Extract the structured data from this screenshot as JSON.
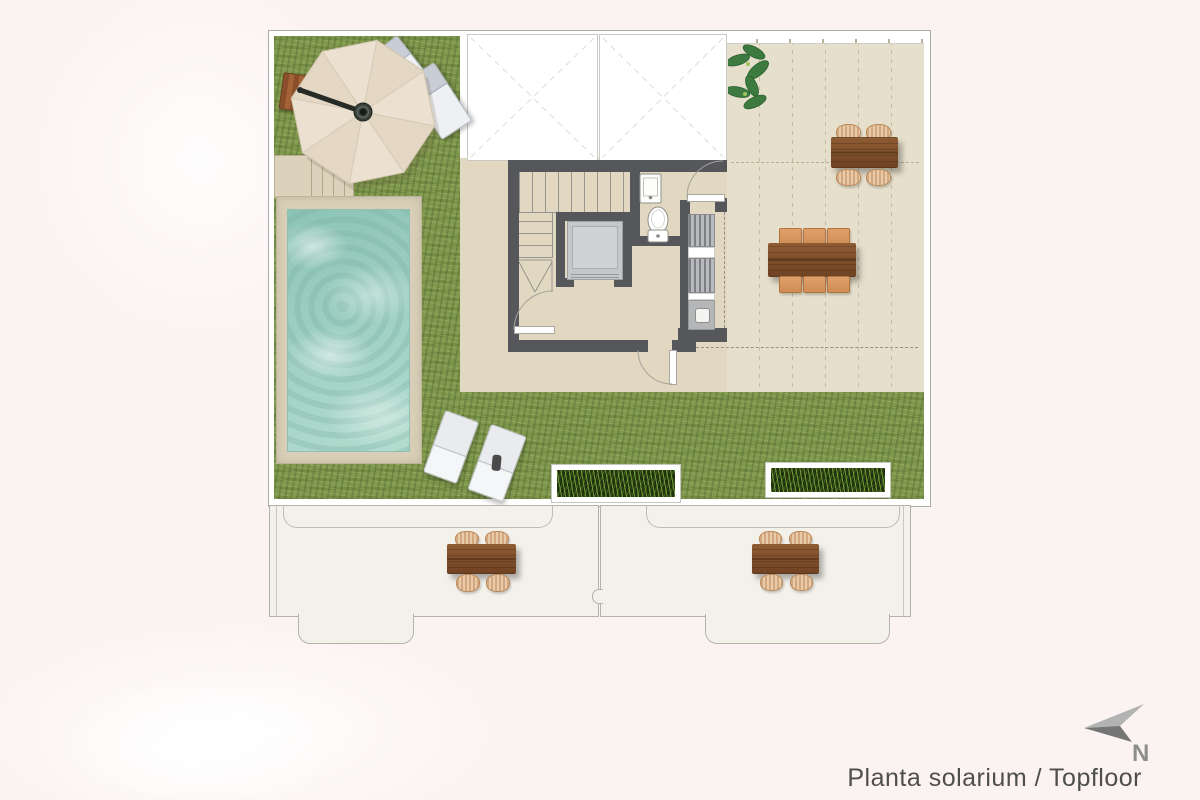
{
  "caption": {
    "text": "Planta solarium / Topfloor"
  },
  "compass": {
    "label": "N",
    "icon": "north-arrow-icon",
    "direction": "upper-left"
  },
  "plan": {
    "type": "architectural-floor-plan",
    "floor": "solarium / top floor",
    "areas": [
      {
        "id": "grass-left",
        "kind": "artificial-grass"
      },
      {
        "id": "grass-bottom-strip",
        "kind": "artificial-grass"
      },
      {
        "id": "pool",
        "kind": "swimming-pool"
      },
      {
        "id": "pool-deck",
        "kind": "deck"
      },
      {
        "id": "pool-steps",
        "kind": "steps"
      },
      {
        "id": "central-deck",
        "kind": "tiled-deck"
      },
      {
        "id": "roof-terrace",
        "kind": "tiled-terrace"
      },
      {
        "id": "skylight-void-1",
        "kind": "roof-void"
      },
      {
        "id": "skylight-void-2",
        "kind": "roof-void"
      },
      {
        "id": "stairwell",
        "kind": "staircase-core"
      },
      {
        "id": "elevator",
        "kind": "lift"
      },
      {
        "id": "toilet-room",
        "kind": "wc"
      },
      {
        "id": "utility-room",
        "kind": "ac-units-and-sink"
      },
      {
        "id": "balcony-left",
        "kind": "lower-floor-terrace"
      },
      {
        "id": "balcony-right",
        "kind": "lower-floor-terrace"
      }
    ],
    "furniture": [
      {
        "id": "cantilever-umbrella",
        "location": "grass-left"
      },
      {
        "id": "side-table-wood",
        "location": "grass-left"
      },
      {
        "id": "sun-lounger-1",
        "location": "grass-left"
      },
      {
        "id": "sun-lounger-2",
        "location": "grass-left"
      },
      {
        "id": "sun-lounger-3",
        "location": "grass-bottom-strip"
      },
      {
        "id": "sun-lounger-4",
        "location": "grass-bottom-strip"
      },
      {
        "id": "dining-set-4-seats",
        "location": "roof-terrace"
      },
      {
        "id": "dining-set-6-seats",
        "location": "roof-terrace"
      },
      {
        "id": "dining-set-4-seats",
        "location": "balcony-left"
      },
      {
        "id": "dining-set-4-seats",
        "location": "balcony-right"
      },
      {
        "id": "planter-1",
        "location": "grass-bottom-strip"
      },
      {
        "id": "planter-2",
        "location": "grass-bottom-strip"
      },
      {
        "id": "plant",
        "location": "roof-terrace"
      }
    ]
  },
  "colors": {
    "page_bg": "#fbf3f1",
    "grass": "#80994d",
    "pool_water": "#a5d4c7",
    "pool_deck": "#d9cfb8",
    "central_deck": "#e2d8c1",
    "terrace": "#e6dfcb",
    "walls": "#56575b",
    "wood": "#7f4f2b",
    "wicker": "#ddb58c",
    "ghost_floor": "#f4f1ea",
    "caption_text": "#4e4e4e"
  }
}
